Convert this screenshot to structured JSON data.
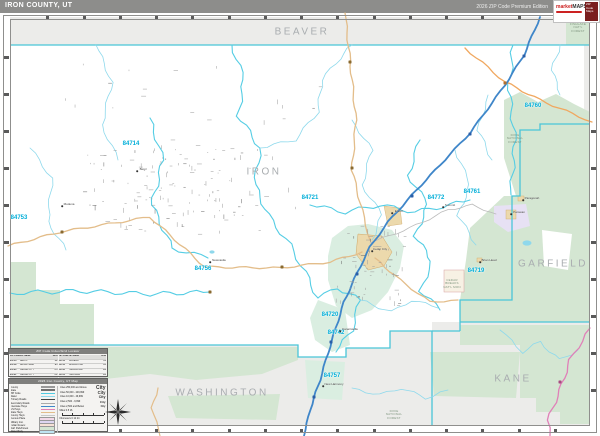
{
  "header": {
    "title": "IRON COUNTY, UT",
    "edition": "2026 ZIP Code Premium Edition",
    "logo_text": "market",
    "logo_text2": "MAPS",
    "logo_badge": "ZIP Code Maps"
  },
  "map": {
    "county_labels": [
      {
        "text": "BEAVER",
        "x": 302,
        "y": 32
      },
      {
        "text": "IRON",
        "x": 264,
        "y": 172
      },
      {
        "text": "GARFIELD",
        "x": 553,
        "y": 264
      },
      {
        "text": "WASHINGTON",
        "x": 222,
        "y": 393
      },
      {
        "text": "KANE",
        "x": 513,
        "y": 379
      }
    ],
    "zip_labels": [
      {
        "text": "84714",
        "x": 131,
        "y": 144
      },
      {
        "text": "84753",
        "x": 19,
        "y": 218
      },
      {
        "text": "84756",
        "x": 203,
        "y": 269
      },
      {
        "text": "84721",
        "x": 310,
        "y": 198
      },
      {
        "text": "84720",
        "x": 330,
        "y": 315
      },
      {
        "text": "84742",
        "x": 336,
        "y": 333
      },
      {
        "text": "84757",
        "x": 332,
        "y": 376
      },
      {
        "text": "84772",
        "x": 436,
        "y": 198
      },
      {
        "text": "84761",
        "x": 472,
        "y": 192
      },
      {
        "text": "84719",
        "x": 476,
        "y": 271
      },
      {
        "text": "84760",
        "x": 533,
        "y": 106
      }
    ],
    "forest_labels": [
      {
        "lines": [
          "DIXIE",
          "NATIONAL",
          "FOREST"
        ],
        "x": 515,
        "y": 139
      },
      {
        "lines": [
          "CEDAR",
          "BREAKS",
          "NAT'L MON"
        ],
        "x": 452,
        "y": 284
      },
      {
        "lines": [
          "DIXIE",
          "NATIONAL",
          "FOREST"
        ],
        "x": 394,
        "y": 415
      },
      {
        "lines": [
          "FISHLAKE",
          "NAT'L",
          "FOREST"
        ],
        "x": 578,
        "y": 28
      }
    ],
    "towns": [
      {
        "name": "Cedar City",
        "x": 372,
        "y": 251,
        "dx": 8,
        "dy": -2
      },
      {
        "name": "Enoch",
        "x": 392,
        "y": 213,
        "dx": 7,
        "dy": -2
      },
      {
        "name": "Parowan",
        "x": 511,
        "y": 214,
        "dx": 8,
        "dy": -2
      },
      {
        "name": "Paragonah",
        "x": 523,
        "y": 200,
        "dx": 9,
        "dy": -2
      },
      {
        "name": "Summit",
        "x": 443,
        "y": 207,
        "dx": 7,
        "dy": -2
      },
      {
        "name": "Kanarraville",
        "x": 340,
        "y": 331,
        "dx": 10,
        "dy": -2
      },
      {
        "name": "New Harmony",
        "x": 323,
        "y": 386,
        "dx": 11,
        "dy": -2
      },
      {
        "name": "Brian Head",
        "x": 480,
        "y": 262,
        "dx": 9,
        "dy": -2
      },
      {
        "name": "Newcastle",
        "x": 210,
        "y": 262,
        "dx": 9,
        "dy": -2
      },
      {
        "name": "Modena",
        "x": 62,
        "y": 206,
        "dx": 7,
        "dy": -2
      },
      {
        "name": "Beryl",
        "x": 137,
        "y": 171,
        "dx": 6,
        "dy": -2
      }
    ]
  },
  "index_box": {
    "title": "ZIP Code Index/Grid Locator",
    "columns": [
      "ZIP Code",
      "ZIP Name",
      "Grid"
    ],
    "rows": [
      [
        "84714",
        "BERYL",
        "B2"
      ],
      [
        "84719",
        "BRIAN HEAD",
        "E3"
      ],
      [
        "84720",
        "CEDAR CITY",
        "D3"
      ],
      [
        "84721",
        "CEDAR CITY",
        "D2"
      ],
      [
        "84742",
        "KANARRAVILLE",
        "D4"
      ],
      [
        "84753",
        "MODENA",
        "A2"
      ],
      [
        "84756",
        "NEWCASTLE",
        "B3"
      ],
      [
        "84760",
        "PARAGONAH",
        "E2"
      ],
      [
        "84761",
        "PAROWAN",
        "E2"
      ],
      [
        "84772",
        "SUMMIT",
        "D2"
      ]
    ]
  },
  "legend": {
    "title": "2026 Iron County, UT Map",
    "line_items": [
      {
        "label": "County",
        "color": "#9a9a9a",
        "w": 2.5
      },
      {
        "label": "State",
        "color": "#707070",
        "w": 2
      },
      {
        "label": "ZIP Code",
        "color": "#4fcbe2",
        "w": 1.2
      },
      {
        "label": "Water",
        "color": "#8ed9ec",
        "w": 1
      },
      {
        "label": "Primary Roads",
        "color": "#444444",
        "w": 1.6
      },
      {
        "label": "Secondary Roads",
        "color": "#aaaaaa",
        "w": 1
      },
      {
        "label": "Interstate Hwys",
        "color": "#3f86c9",
        "w": 1.6
      },
      {
        "label": "US Hwys",
        "color": "#e080b8",
        "w": 1.4
      },
      {
        "label": "State Hwys",
        "color": "#e3bd8a",
        "w": 1.4
      },
      {
        "label": "County Hwys",
        "color": "#c8c8c8",
        "w": 1
      }
    ],
    "area_items": [
      {
        "label": "Census Place",
        "color": "#f3d8e8"
      },
      {
        "label": "Military Inst.",
        "color": "#ddd6f0"
      },
      {
        "label": "Indian Reserv.",
        "color": "#f6e2d6"
      },
      {
        "label": "Nat'l Park/Forest",
        "color": "#d4e6d2"
      },
      {
        "label": "Water Body",
        "color": "#bfe4f2"
      }
    ],
    "city_items": [
      {
        "label": "Cities 250,000 and Above",
        "sample": "City",
        "size": 5
      },
      {
        "label": "Cities 50,000 - 249,999",
        "sample": "City",
        "size": 4.2
      },
      {
        "label": "Cities 10,000 - 49,999",
        "sample": "City",
        "size": 3.6
      },
      {
        "label": "Cities 2,500 - 9,999",
        "sample": "City",
        "size": 3
      },
      {
        "label": "Cities 2,500 and Below",
        "sample": "City",
        "size": 2.6
      }
    ],
    "scale": {
      "miles_label": "Miles",
      "miles_ticks": "0        8        16",
      "km_label": "Kilometers",
      "km_ticks": "0     12     24"
    }
  }
}
